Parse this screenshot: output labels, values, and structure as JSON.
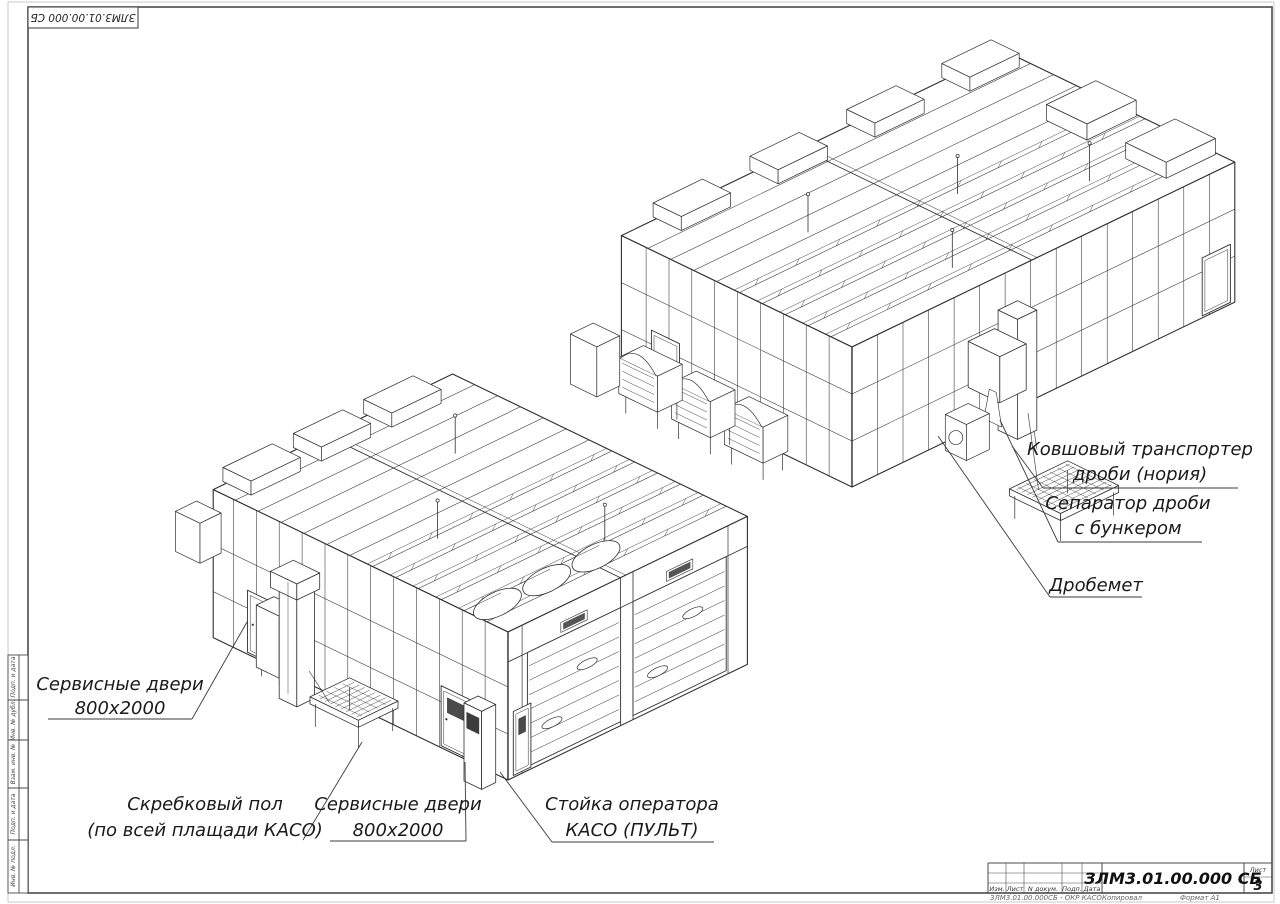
{
  "sheet": {
    "top_stamp": "ЗЛМ3.01.00.000 СБ",
    "title_block": {
      "doc_number": "ЗЛМ3.01.00.000 СБ",
      "sheet_label": "Лист",
      "sheet_number": "3",
      "columns": [
        "Изм.",
        "Лист",
        "N докум.",
        "Подп.",
        "Дата"
      ],
      "footer_left": "ЗЛМ3.01.00.000СБ - ОКР КАСО",
      "footer_copy": "Копировал",
      "footer_format": "Формат А1"
    },
    "side_stamp": [
      "Подп. и дата",
      "Инв. № дубл.",
      "Взам. инв. №",
      "Подп. и дата",
      "Инв. № подл."
    ],
    "colors": {
      "ink": "#2f2f2f",
      "text": "#1a1a1a"
    }
  },
  "annotations": [
    {
      "id": "bucket-conveyor",
      "lines": [
        "Ковшовый транспортер",
        "дроби (нория)"
      ]
    },
    {
      "id": "shot-separator",
      "lines": [
        "Сепаратор дроби",
        "с бункером"
      ]
    },
    {
      "id": "shot-blaster",
      "lines": [
        "Дробемет"
      ]
    },
    {
      "id": "service-door-left",
      "lines": [
        "Сервисные двери",
        "800х2000"
      ]
    },
    {
      "id": "scraper-floor",
      "lines": [
        "Скребковый пол",
        "(по всей плащади КАСО)"
      ]
    },
    {
      "id": "service-door-front",
      "lines": [
        "Сервисные двери",
        "800х2000"
      ]
    },
    {
      "id": "operator-stand",
      "lines": [
        "Стойка оператора",
        "КАСО (ПУЛЬТ)"
      ]
    }
  ]
}
